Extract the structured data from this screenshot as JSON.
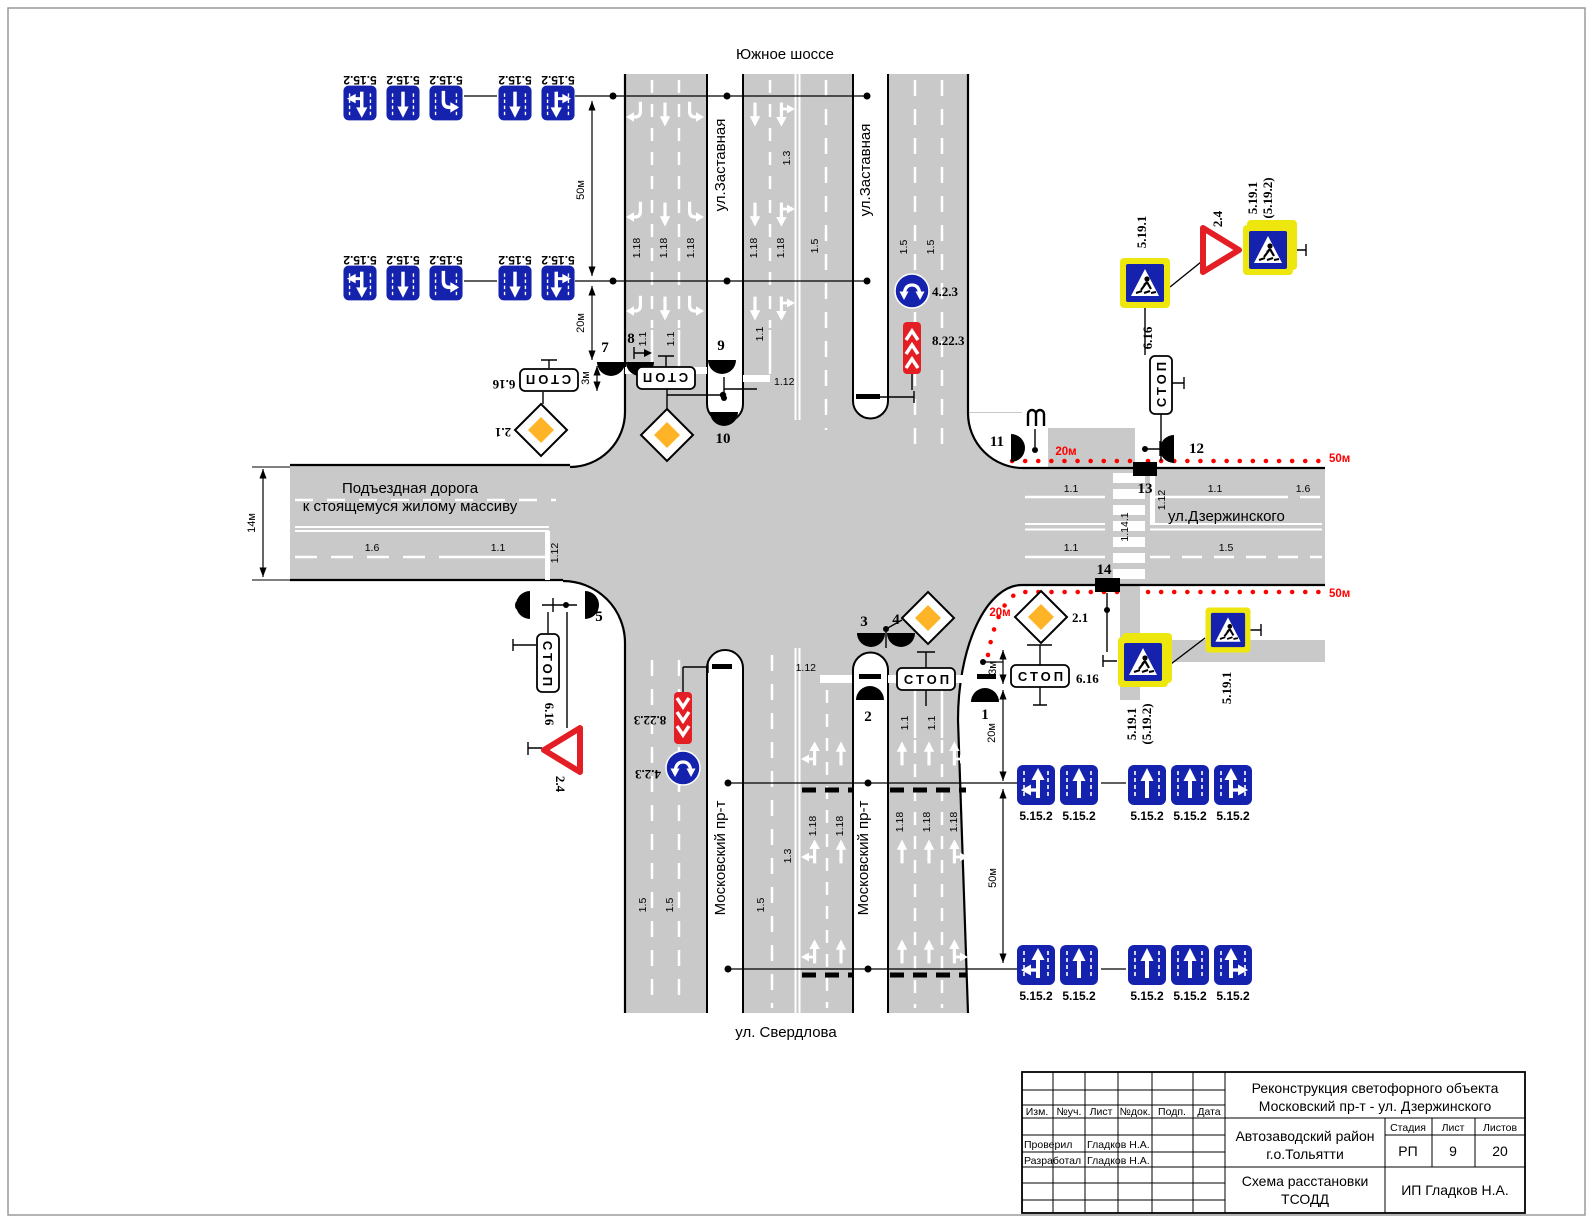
{
  "roads": {
    "north": "Южное шоссе",
    "south": "ул. Свердлова",
    "east": "ул.Дзержинского",
    "west_line1": "Подъездная дорога",
    "west_line2": "к стоящемуся жилому массиву",
    "median_north": "ул.Заставная",
    "median_south": "Московский пр-т"
  },
  "codes": {
    "lane_sign": "5.15.2",
    "crossing": "5.19.1",
    "crossing_alt": "(5.19.2)",
    "stop_plate": "6.16",
    "stop_text": "СТОП",
    "priority": "2.1",
    "give_way": "2.4",
    "detour": "4.2.3",
    "chevron": "8.22.3",
    "m_1_1": "1.1",
    "m_1_3": "1.3",
    "m_1_5": "1.5",
    "m_1_6": "1.6",
    "m_1_12": "1.12",
    "m_1_14_1": "1.14.1",
    "m_1_18": "1.18"
  },
  "dimensions": {
    "d50": "50м",
    "d20": "20м",
    "d14": "14м",
    "d3": "3м"
  },
  "signals": [
    "1",
    "2",
    "3",
    "4",
    "5",
    "6",
    "7",
    "8",
    "9",
    "10",
    "11",
    "12",
    "13",
    "14"
  ],
  "colors": {
    "road_gray": "#c9c9c9",
    "sign_blue": "#1522ad",
    "sign_red": "#e31e24",
    "delineator_red": "#ff0000",
    "priority_orange": "#ffb327",
    "crossing_frame_yellow": "#ede70e"
  },
  "title_block": {
    "project_line1": "Реконструкция светофорного объекта",
    "project_line2": "Московский пр-т - ул. Дзержинского",
    "district_line1": "Автозаводский район",
    "district_line2": "г.о.Тольятти",
    "scheme_line1": "Схема расстановки",
    "scheme_line2": "ТСОДД",
    "company": "ИП Гладков Н.А.",
    "stage_label": "Стадия",
    "sheet_label": "Лист",
    "sheets_label": "Листов",
    "stage": "РП",
    "sheet": "9",
    "sheets": "20",
    "col_izm": "Изм.",
    "col_uch": "№уч.",
    "col_list": "Лист",
    "col_dok": "№док.",
    "col_podp": "Подп.",
    "col_data": "Дата",
    "checked_label": "Проверил",
    "developed_label": "Разработал",
    "checked_by": "Гладков Н.А.",
    "developed_by": "Гладков Н.А."
  }
}
